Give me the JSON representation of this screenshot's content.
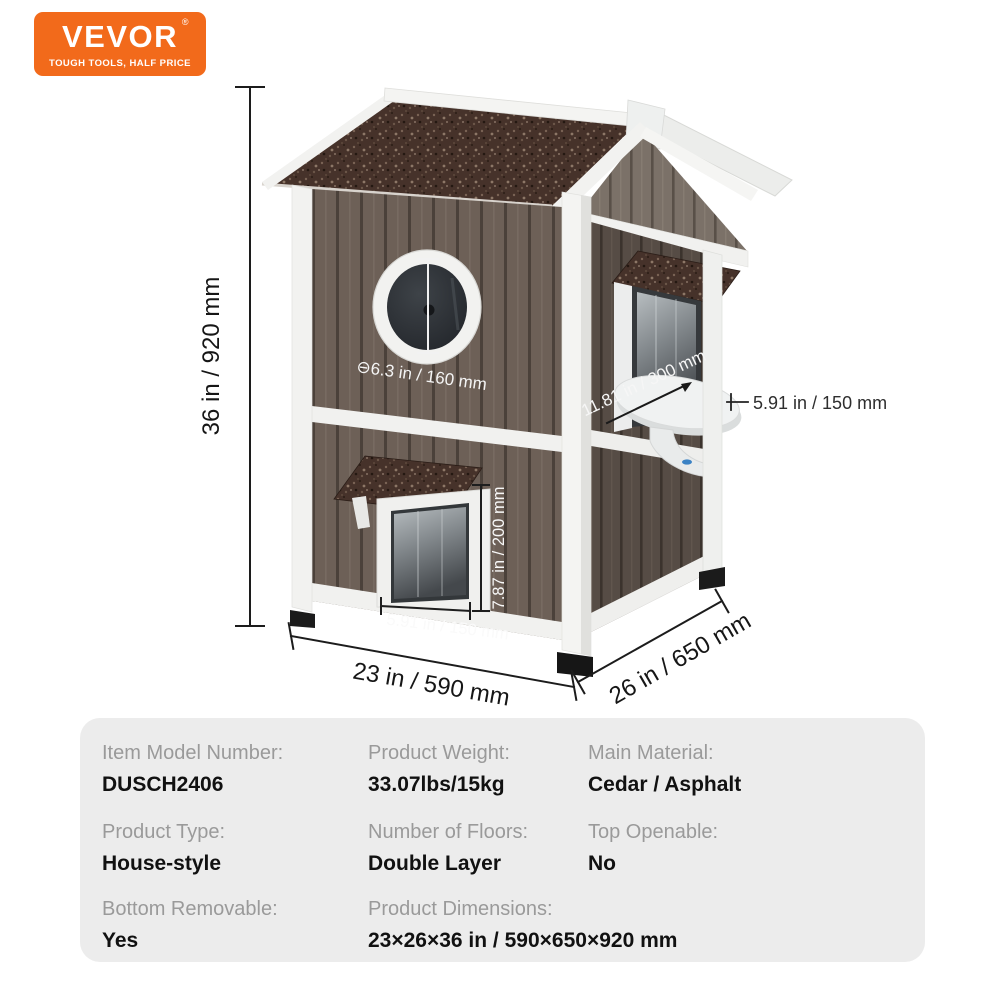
{
  "logo": {
    "brand": "VEVOR",
    "registered": "®",
    "tagline": "TOUGH TOOLS, HALF PRICE",
    "bg_color": "#F26A1B",
    "text_color": "#FFFFFF"
  },
  "annotations": {
    "height": "36 in / 920 mm",
    "window_diameter": "⊖6.3 in / 160 mm",
    "side_opening": "11.81 in / 300 mm",
    "perch_depth": "5.91 in / 150 mm",
    "door_height": "7.87 in / 200 mm",
    "door_width": "5.91 in / 150 mm",
    "base_width": "23 in / 590 mm",
    "base_depth": "26 in / 650 mm"
  },
  "colors": {
    "roof_asphalt": "#46322A",
    "front_planks": "#6D6057",
    "side_planks": "#564C45",
    "gable_planks": "#7B7168",
    "white_trim": "#F2F2F0",
    "table_bg": "#ECECEC",
    "dim_line": "#1C1C1C"
  },
  "specs": {
    "rows": [
      [
        {
          "label": "Item Model Number:",
          "value": "DUSCH2406"
        },
        {
          "label": "Product Weight:",
          "value": "33.07lbs/15kg"
        },
        {
          "label": "Main Material:",
          "value": "Cedar / Asphalt"
        }
      ],
      [
        {
          "label": "Product Type:",
          "value": "House-style"
        },
        {
          "label": "Number of Floors:",
          "value": "Double Layer"
        },
        {
          "label": "Top Openable:",
          "value": "No"
        }
      ],
      [
        {
          "label": "Bottom Removable:",
          "value": "Yes"
        },
        {
          "label": "Product Dimensions:",
          "value": "23×26×36 in / 590×650×920 mm"
        }
      ]
    ]
  }
}
